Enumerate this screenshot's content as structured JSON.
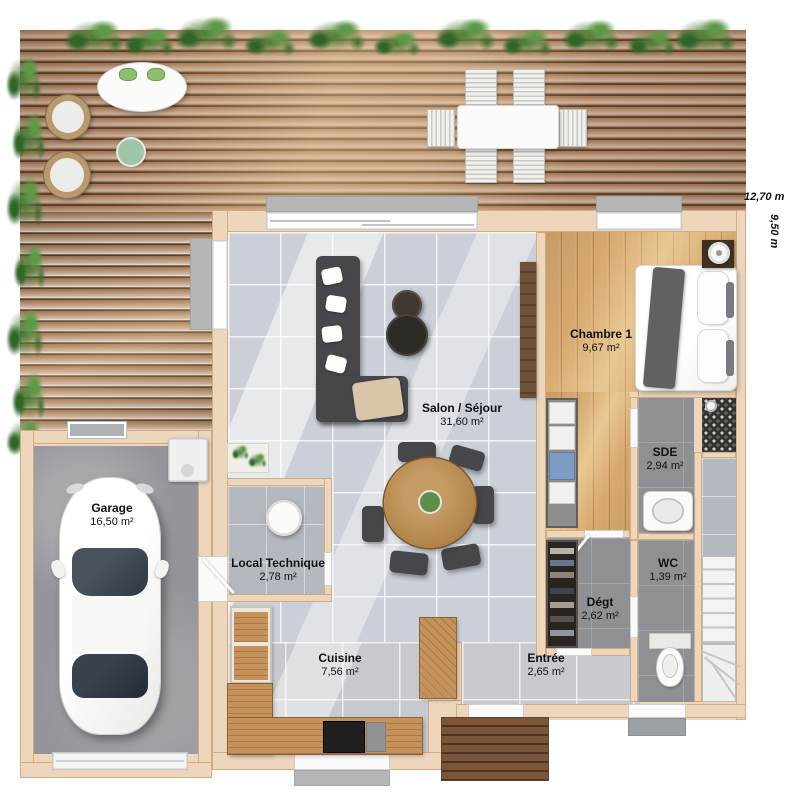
{
  "dimensions": {
    "width": "12,70 m",
    "height": "9,50 m"
  },
  "rooms": {
    "salon": {
      "name": "Salon / Séjour",
      "area": "31,60 m²"
    },
    "chambre": {
      "name": "Chambre 1",
      "area": "9,67 m²"
    },
    "sde": {
      "name": "SDE",
      "area": "2,94 m²"
    },
    "wc": {
      "name": "WC",
      "area": "1,39 m²"
    },
    "degt": {
      "name": "Dégt",
      "area": "2,62 m²"
    },
    "entree": {
      "name": "Entrée",
      "area": "2,65 m²"
    },
    "cuisine": {
      "name": "Cuisine",
      "area": "7,56 m²"
    },
    "local": {
      "name": "Local Technique",
      "area": "2,78 m²"
    },
    "garage": {
      "name": "Garage",
      "area": "16,50 m²"
    }
  },
  "palette": {
    "wall": "#eed6bd",
    "deck_wood": "#9c6c46",
    "tile_floor": "#cbd0d8",
    "bedroom_wood": "#cf9d63",
    "wet_room_floor": "#8e9093",
    "plant_green": "#4a7c3f",
    "label_text": "#111111"
  }
}
